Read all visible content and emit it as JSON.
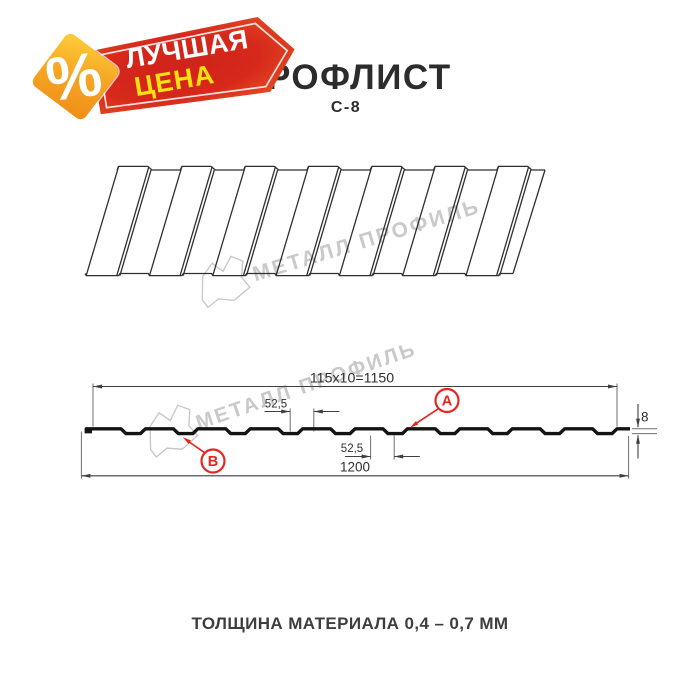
{
  "header": {
    "title": "ПРОФЛИСТ",
    "subtitle": "С-8"
  },
  "badge": {
    "percent_symbol": "%",
    "line1": "ЛУЧШАЯ",
    "line2": "ЦЕНА"
  },
  "watermark": {
    "brand": "МЕТАЛЛ ПРОФИЛЬ"
  },
  "section_diagram": {
    "dim_total_top": "115x10=1150",
    "dim_rib_top": "52,5",
    "dim_rib_bottom": "52,5",
    "dim_height": "8",
    "dim_total_bottom": "1200",
    "marker_a": "A",
    "marker_b": "B"
  },
  "footer": {
    "thickness_note": "ТОЛЩИНА МАТЕРИАЛА 0,4 – 0,7 ММ"
  },
  "colors": {
    "accent_red": "#e8251d",
    "watermark_gray": "#c9c9c9",
    "profile_line": "#141414",
    "sheet_line": "#2f2f2f",
    "dim_line": "#3f3f3f",
    "ext_line": "#6e6e6e",
    "dim_text": "#2f2f2f",
    "banner_red": "#d5251a",
    "banner_orange": "#eb5a28",
    "diamond_orange_light": "#fdca38",
    "diamond_orange_deep": "#f08f18",
    "price_yellow": "#ffe10d"
  }
}
